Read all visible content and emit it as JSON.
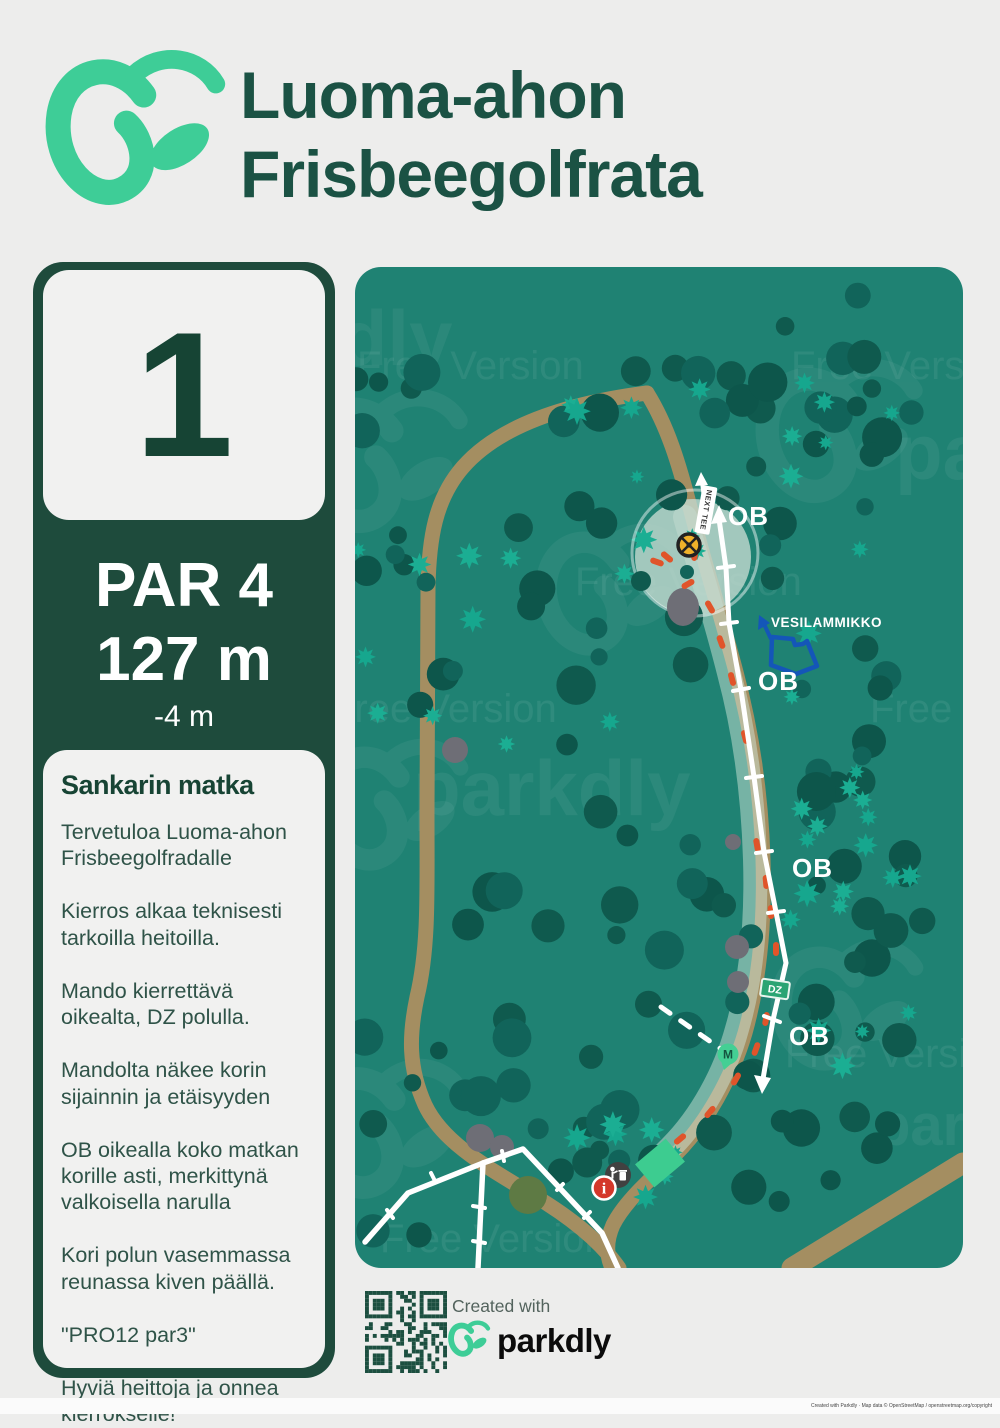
{
  "header": {
    "title_line1": "Luoma-ahon",
    "title_line2": "Frisbeegolfrata"
  },
  "hole": {
    "number": "1",
    "par_label": "PAR 4",
    "distance": "127 m",
    "elevation": "-4 m"
  },
  "notes": {
    "title": "Sankarin matka",
    "paragraphs": [
      "Tervetuloa Luoma-ahon Frisbeegolfradalle",
      "Kierros alkaa teknisesti tarkoilla heitoilla.",
      "Mando kierrettävä oikealta, DZ  polulla.",
      "Mandolta näkee korin sijainnin ja etäisyyden",
      "OB oikealla koko matkan korille asti, merkittynä valkoisella narulla",
      "Kori polun vasemmassa reunassa kiven päällä.",
      "\"PRO12 par3\"",
      "Hyviä heittoja ja onnea kierrokselle!"
    ]
  },
  "map": {
    "labels": {
      "ob": "OB",
      "pond": "VESILAMMIKKO",
      "next_tee": "NEXT TEE",
      "dropzone": "DZ",
      "mando": "M",
      "info": "i"
    },
    "watermark": {
      "free_version": "Free Version",
      "brand": "parkdly"
    },
    "colors": {
      "map_teal": "#1f8273",
      "tree_dark": "#0f5a4e",
      "bush_teal": "#16a78e",
      "trail_tan": "#a48e61",
      "ob_rope_orange": "#e0542a",
      "pond_blue": "#1456b8",
      "basket_yellow": "#efb12a",
      "tee_green": "#3dcc90",
      "info_red": "#d4372a",
      "panel_green": "#1e4b3c",
      "accent_mint": "#3ecd97"
    }
  },
  "footer": {
    "created_with": "Created with",
    "brand": "parkdly",
    "copyright": "Created with Parkdly · Map data © OpenStreetMap / openstreetmap.org/copyright"
  }
}
